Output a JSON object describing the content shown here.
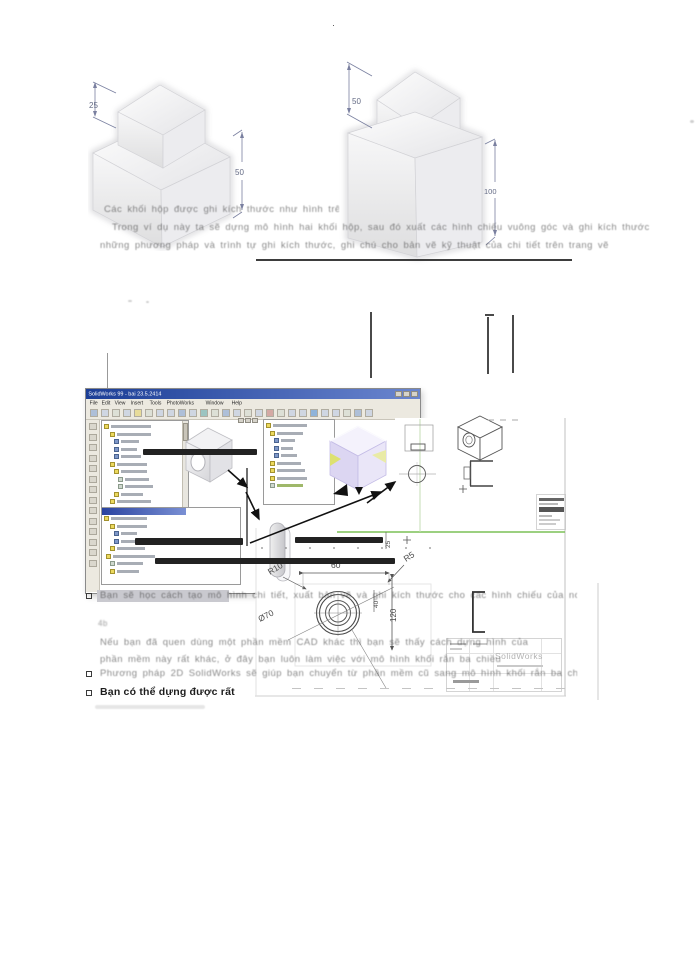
{
  "page": {
    "corner_mark": "·"
  },
  "top_figures": {
    "left": {
      "dim_small": "25",
      "dim_large": "50"
    },
    "right": {
      "dim_small": "50",
      "dim_large": "100"
    }
  },
  "intro": {
    "line1": "Các khối hộp được ghi kích thước như hình trên",
    "line2": "Trong ví dụ này ta sẽ dựng mô hình hai khối hộp, sau đó xuất các hình chiếu vuông góc và ghi kích thước",
    "line3": "những phương pháp và trình tự ghi kích thước, ghi chú cho bản vẽ kỹ thuật của chi tiết trên trang vẽ"
  },
  "sw_window": {
    "title": "SolidWorks 99 - bai 23.5.2414",
    "menus": [
      "File",
      "Edit",
      "View",
      "Insert",
      "Tools",
      "PhotoWorks",
      "Window",
      "Help"
    ]
  },
  "drawing": {
    "dim_r10": "R10",
    "dim_60": "60",
    "dim_r5": "R5",
    "dim_dia70": "Ø70",
    "dim_120": "120",
    "dim_40": "40",
    "dim_25": "25",
    "brand": "SolidWorks"
  },
  "bottom": {
    "bullet1": "Bạn sẽ học cách tạo mô hình chi tiết, xuất bản vẽ và ghi kích thước cho các hình chiếu của nó",
    "sub_label": "4b",
    "para1": "Nếu bạn đã quen dùng một phần mềm CAD khác thì bạn sẽ thấy cách dựng hình của",
    "para2": "phần mềm này rất khác, ở đây bạn luôn làm việc với mô hình khối rắn ba chiều",
    "bullet2": "Phương pháp 2D SolidWorks sẽ giúp bạn chuyển từ phần mềm cũ sang mô hình khối rắn ba chiều",
    "bullet3": "Bạn có thể dựng được rất"
  }
}
